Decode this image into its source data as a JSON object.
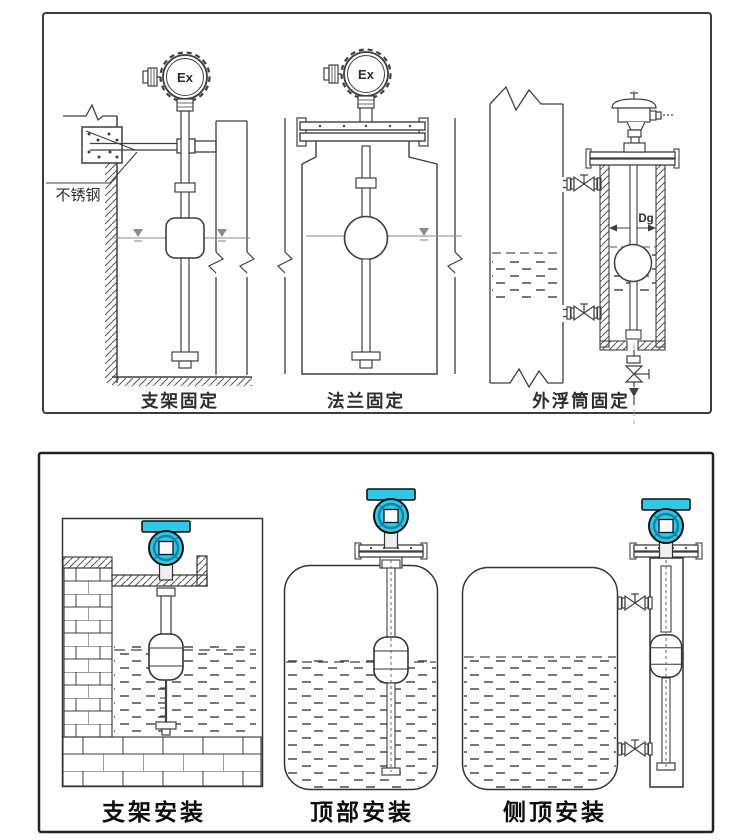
{
  "colors": {
    "accent": "#2ec9e8",
    "accent_dark": "#0d85a6",
    "line": "#3f3f3f",
    "caption": "#1a1a1a"
  },
  "top_panel": {
    "captions": [
      {
        "label": "支架固定"
      },
      {
        "label": "法兰固定"
      },
      {
        "label": "外浮筒固定"
      }
    ],
    "labels": {
      "stainless_steel": "不锈钢",
      "ex_marking": "Ex",
      "chamber_diameter": "Dg"
    }
  },
  "bottom_panel": {
    "captions": [
      {
        "label": "支架安装"
      },
      {
        "label": "顶部安装"
      },
      {
        "label": "侧顶安装"
      }
    ]
  }
}
